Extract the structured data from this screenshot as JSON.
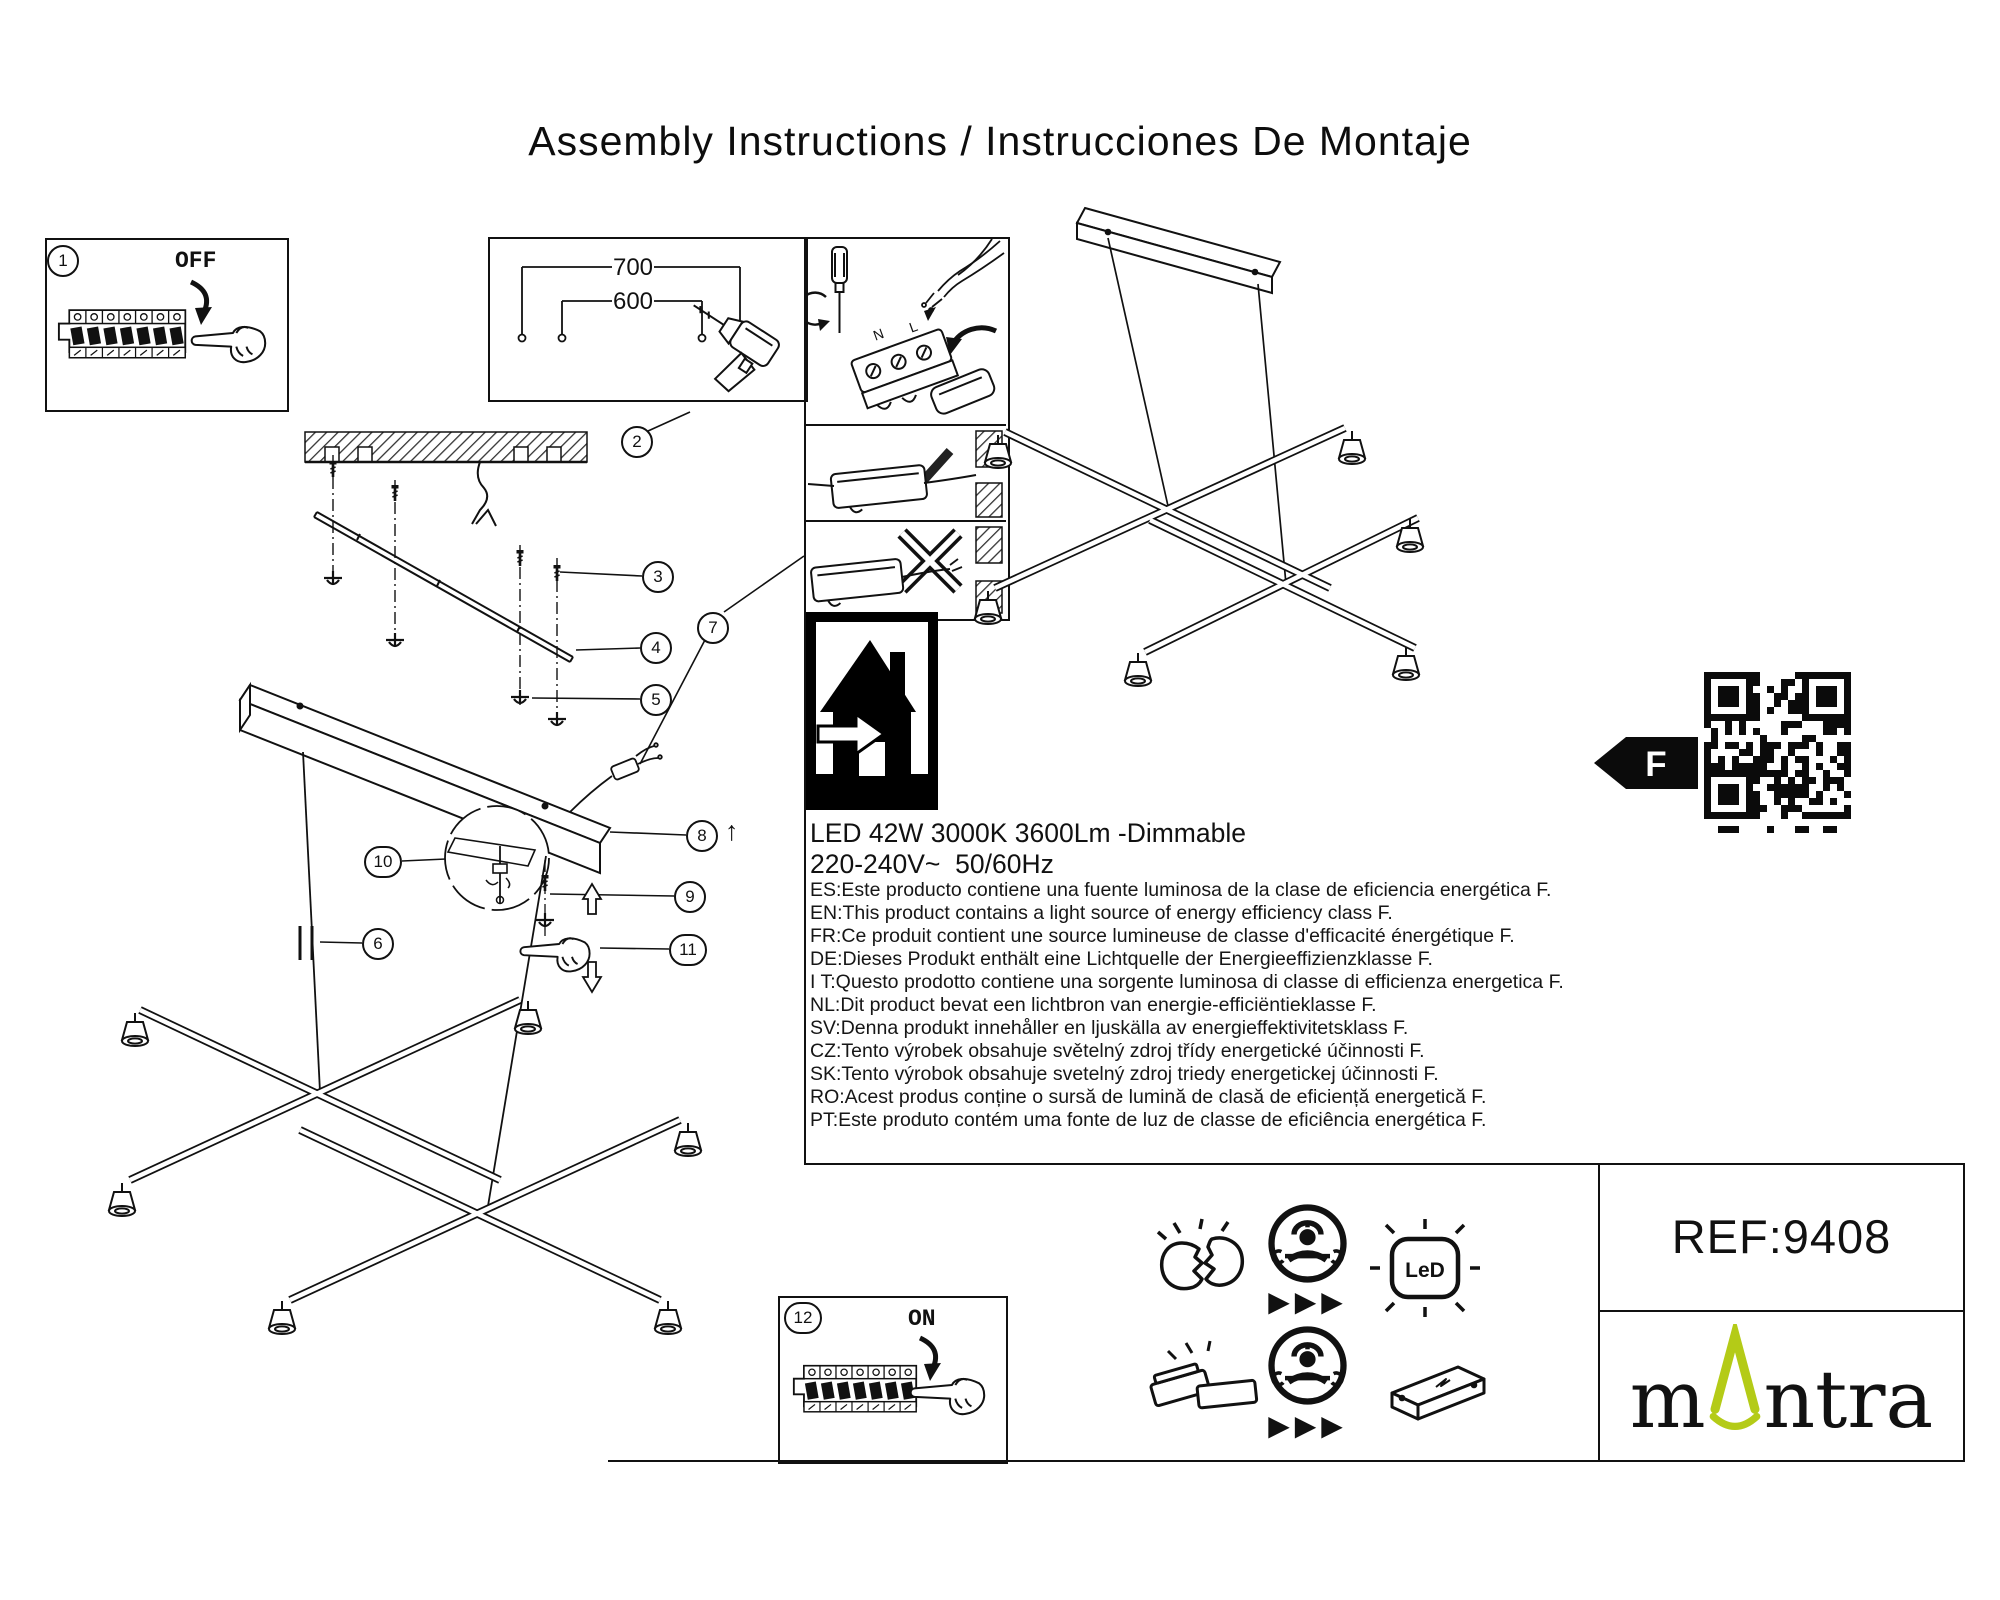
{
  "title": "Assembly Instructions / Instrucciones De Montaje",
  "callouts": [
    "1",
    "2",
    "3",
    "4",
    "5",
    "6",
    "7",
    "8",
    "9",
    "10",
    "11",
    "12"
  ],
  "steps": {
    "power_off": "OFF",
    "power_on": "ON"
  },
  "dimensions": {
    "outer_mm": "700",
    "inner_mm": "600"
  },
  "wiring": {
    "neutral": "N",
    "live": "L"
  },
  "specs": {
    "line1": "LED 42W 3000K 3600Lm -Dimmable",
    "line2": "220-240V~  50/60Hz"
  },
  "energy_statements": [
    "ES:Este producto contiene una fuente luminosa de la clase de eficiencia energética F.",
    "EN:This product contains a light source of energy efficiency class F.",
    "FR:Ce produit contient une source lumineuse de classe d'efficacité énergétique F.",
    "DE:Dieses Produkt enthält eine Lichtquelle der Energieeffizienzklasse F.",
    "I T:Questo prodotto contiene una sorgente luminosa di classe di efficienza energetica F.",
    "NL:Dit product bevat een lichtbron van energie-efficiëntieklasse F.",
    "SV:Denna produkt innehåller en ljuskälla av energieffektivitetsklass F.",
    "CZ:Tento výrobek obsahuje světelný zdroj třídy energetické účinnosti F.",
    "SK:Tento výrobok obsahuje svetelný zdroj triedy energetickej účinnosti F.",
    "RO:Acest produs conține o sursă de lumină de clasă de eficiență energetică F.",
    "PT:Este produto contém uma fonte de luz de classe de eficiência energética F."
  ],
  "energy_class": "F",
  "ref": "REF:9408",
  "brand": {
    "prefix": "m",
    "suffix": "ntra"
  },
  "brand_color": "#b4cb17",
  "icons": {
    "led_badge": "LeD",
    "arrows": "▶▶▶",
    "up_arrow": "↑"
  }
}
